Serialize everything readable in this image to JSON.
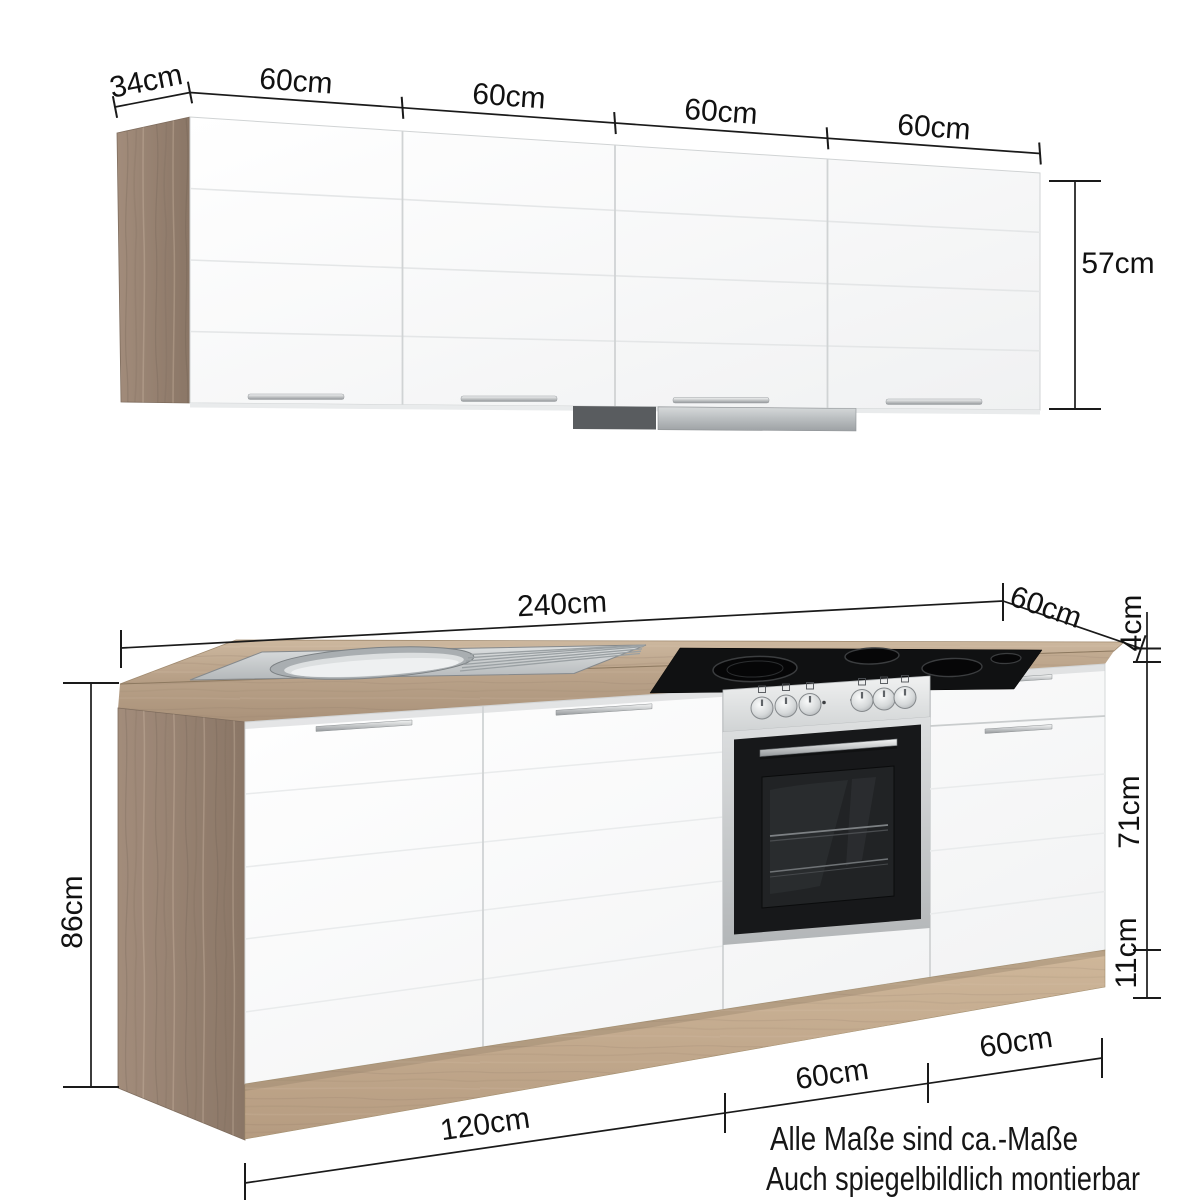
{
  "diagram": {
    "wall_cabinet": {
      "depth": "34cm",
      "door_widths": [
        "60cm",
        "60cm",
        "60cm",
        "60cm"
      ],
      "height": "57cm"
    },
    "base_cabinet": {
      "total_width": "240cm",
      "depth": "60cm",
      "worktop_thickness": "4cm",
      "total_height": "86cm",
      "front_height": "71cm",
      "plinth_height": "11cm",
      "segment_widths": [
        "120cm",
        "60cm",
        "60cm"
      ]
    },
    "notes": {
      "line1": "Alle Maße sind ca.-Maße",
      "line2": "Auch spiegelbildlich montierbar"
    },
    "colors": {
      "wood_side": "#997f6d",
      "wood_worktop": "#c2ab92",
      "front_white": "#fbfcfc",
      "dimension_ink": "#1a1a1a",
      "appliance_black": "#17181a",
      "stainless": "#c9cdcf"
    }
  }
}
